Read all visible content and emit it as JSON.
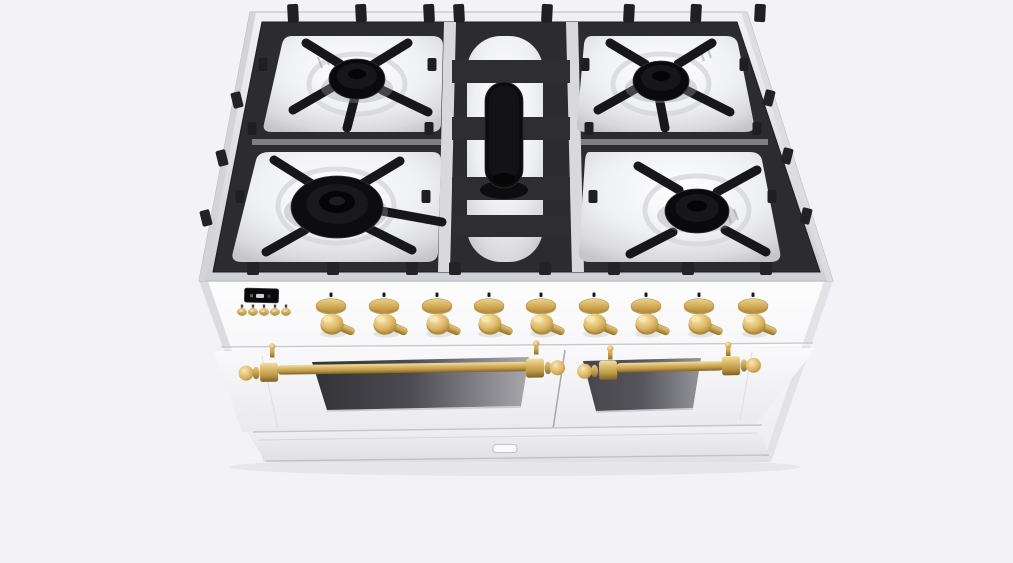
{
  "scene": {
    "description": "3D product render of a white freestanding dual-fuel gas range with brass hardware, viewed from the upper front",
    "background_color": "#f2f2f7"
  },
  "colors": {
    "body_white": "#f7f7fa",
    "cooktop_rim": "#e2e3e7",
    "grate_dark": "#2c2c2f",
    "grate_finger": "#17171a",
    "burner_black": "#0a0a0c",
    "well_steel": "#eff0f2",
    "brass": "#d6b262",
    "brass_highlight": "#f2dfa0",
    "brass_shadow": "#8f6f2c",
    "oven_window": "#4a4a50",
    "seam_gray": "#c7c7cc"
  },
  "cooktop": {
    "grate_sections": 3,
    "burners": [
      {
        "id": "rear-left-burner",
        "type": "sealed-burner"
      },
      {
        "id": "front-left-burner",
        "type": "large-dual-ring-burner"
      },
      {
        "id": "center-burner",
        "type": "elongated-oval-burner"
      },
      {
        "id": "rear-right-burner",
        "type": "sealed-burner"
      },
      {
        "id": "front-right-burner",
        "type": "sealed-burner"
      }
    ]
  },
  "control_panel": {
    "display": {
      "id": "clock-timer-display",
      "text": ""
    },
    "buttons": [
      {
        "id": "control-button-1"
      },
      {
        "id": "control-button-2"
      },
      {
        "id": "control-button-3"
      },
      {
        "id": "control-button-4"
      },
      {
        "id": "control-button-5"
      }
    ],
    "knobs": [
      {
        "id": "burner-knob-1"
      },
      {
        "id": "burner-knob-2"
      },
      {
        "id": "burner-knob-3"
      },
      {
        "id": "burner-knob-4"
      },
      {
        "id": "burner-knob-5"
      },
      {
        "id": "burner-knob-6"
      },
      {
        "id": "burner-knob-7"
      },
      {
        "id": "burner-knob-8"
      },
      {
        "id": "burner-knob-9"
      }
    ]
  },
  "doors": {
    "left": {
      "id": "oven-door-left",
      "handle": "brass-rail-handle",
      "window": true
    },
    "right": {
      "id": "oven-door-right",
      "handle": "brass-rail-handle",
      "window": true
    }
  },
  "kick_panel": {
    "latch": true
  },
  "layout": {
    "knob_xs": [
      331,
      384,
      437,
      489,
      541,
      594,
      646,
      699,
      753
    ],
    "button_xs": [
      242,
      253,
      264,
      275,
      286
    ],
    "top_prong_xs": [
      293,
      361,
      429,
      459,
      547,
      629,
      696,
      760
    ],
    "front_bump_xs": [
      253,
      333,
      412,
      455,
      545,
      614,
      688,
      766
    ],
    "left_edge_prongs": [
      [
        237,
        100
      ],
      [
        222,
        158
      ],
      [
        206,
        218
      ]
    ],
    "right_edge_prongs": [
      [
        769,
        98
      ],
      [
        787,
        156
      ],
      [
        806,
        216
      ]
    ],
    "inner_prongs": [
      [
        263,
        64
      ],
      [
        252,
        128
      ],
      [
        240,
        196
      ],
      [
        432,
        64
      ],
      [
        429,
        128
      ],
      [
        426,
        196
      ],
      [
        585,
        64
      ],
      [
        589,
        128
      ],
      [
        593,
        196
      ],
      [
        744,
        64
      ],
      [
        757,
        128
      ],
      [
        772,
        196
      ]
    ],
    "grate_fingers": [
      [
        340,
        64,
        306,
        43
      ],
      [
        374,
        64,
        408,
        43
      ],
      [
        331,
        88,
        293,
        110
      ],
      [
        382,
        90,
        428,
        112
      ],
      [
        355,
        97,
        347,
        128
      ],
      [
        645,
        64,
        610,
        43
      ],
      [
        678,
        64,
        712,
        43
      ],
      [
        637,
        88,
        598,
        110
      ],
      [
        686,
        90,
        730,
        112
      ],
      [
        659,
        97,
        665,
        128
      ],
      [
        312,
        184,
        274,
        160
      ],
      [
        362,
        184,
        400,
        161
      ],
      [
        305,
        230,
        266,
        252
      ],
      [
        368,
        228,
        412,
        250
      ],
      [
        376,
        210,
        442,
        222
      ],
      [
        679,
        190,
        638,
        166
      ],
      [
        717,
        192,
        757,
        170
      ],
      [
        673,
        232,
        630,
        254
      ],
      [
        725,
        230,
        766,
        252
      ]
    ],
    "burner_wells": [
      [
        357,
        84,
        48,
        30
      ],
      [
        661,
        84,
        48,
        30
      ],
      [
        336,
        206,
        58,
        37
      ],
      [
        697,
        210,
        52,
        34
      ]
    ]
  }
}
